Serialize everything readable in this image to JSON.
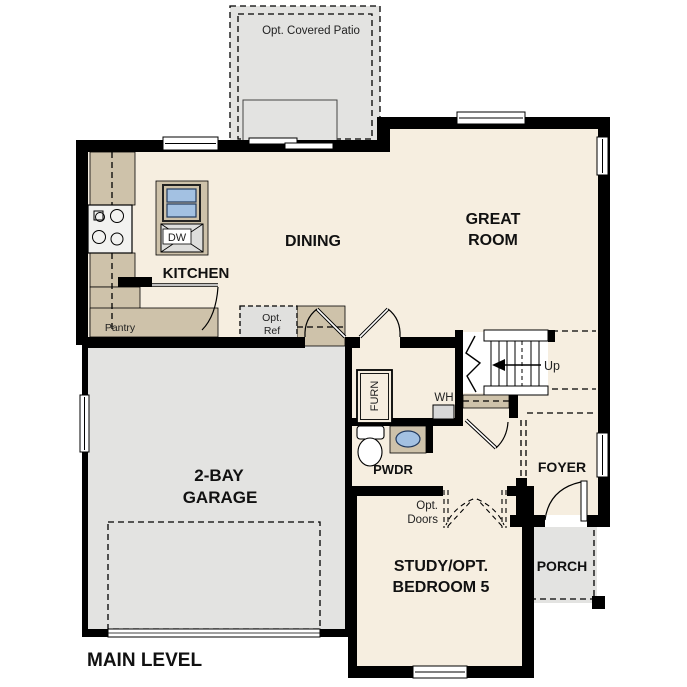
{
  "plan": {
    "title": "MAIN LEVEL"
  },
  "patio": {
    "label": "Opt. Covered Patio"
  },
  "rooms": {
    "kitchen": {
      "label": "KITCHEN"
    },
    "dining": {
      "label": "DINING"
    },
    "great_room": {
      "lines": [
        "GREAT",
        "ROOM"
      ]
    },
    "garage": {
      "lines": [
        "2-BAY",
        "GARAGE"
      ]
    },
    "study": {
      "lines": [
        "STUDY/OPT.",
        "BEDROOM 5"
      ]
    },
    "foyer": {
      "label": "FOYER"
    },
    "porch": {
      "label": "PORCH"
    },
    "powder": {
      "label": "PWDR"
    }
  },
  "fixtures": {
    "dishwasher": "DW",
    "furnace": "FURN",
    "water_heater": "WH",
    "pantry": "Pantry",
    "opt_ref": {
      "lines": [
        "Opt.",
        "Ref"
      ]
    },
    "opt_doors": {
      "lines": [
        "Opt.",
        "Doors"
      ]
    },
    "stairs": {
      "direction": "Up"
    }
  },
  "colors": {
    "wall": "#000000",
    "floor": "#f6eee0",
    "garage_floor": "#e3e3e1",
    "counter": "#cec2aa",
    "sink_blue": "#a3c1e2",
    "appliance_gray": "#d8d8d8"
  }
}
